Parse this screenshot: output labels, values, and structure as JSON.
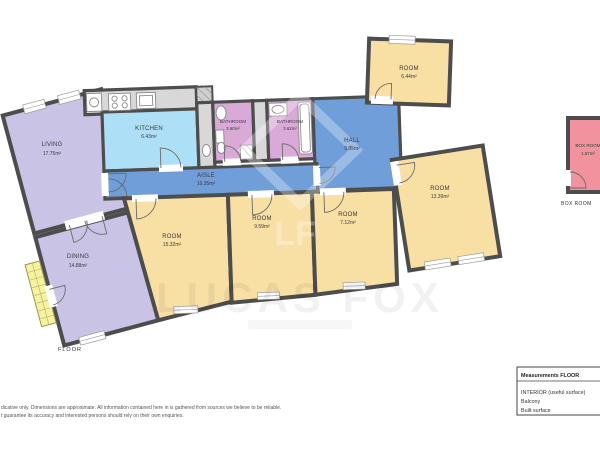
{
  "rooms": [
    {
      "name": "LIVING",
      "area": "17.75m²"
    },
    {
      "name": "DINING",
      "area": "14.88m²"
    },
    {
      "name": "KITCHEN",
      "area": "6.43m²"
    },
    {
      "name": "BATHROOM",
      "area": "3.60m²"
    },
    {
      "name": "BATHROOM",
      "area": "3.62m²"
    },
    {
      "name": "AISLE",
      "area": "10.35m²"
    },
    {
      "name": "HALL",
      "area": "9.85m²"
    },
    {
      "name": "ROOM",
      "area": "6.44m²"
    },
    {
      "name": "ROOM",
      "area": "15.32m²"
    },
    {
      "name": "ROOM",
      "area": "9.59m²"
    },
    {
      "name": "ROOM",
      "area": "7.12m²"
    },
    {
      "name": "ROOM",
      "area": "13.39m²"
    },
    {
      "name": "BOX ROOM",
      "area": "1.87m²"
    }
  ],
  "captions": {
    "floor": "FLOOR",
    "box_room": "BOX ROOM"
  },
  "legend": {
    "title": "Measurements FLOOR",
    "items": [
      "INTERIOR (useful surface)",
      "Balcony",
      "Built surface"
    ]
  },
  "disclaimer": [
    "dicative only. Dimensions are approximate. All information contained here in is gathered from sources we believe to be reliable.",
    "t guarantee its accuracy and interested persons should rely on their own enquiries."
  ],
  "watermark": {
    "text": "LUCAS FOX",
    "logo": "LF"
  },
  "colors": {
    "unit": "#c9c3e6",
    "kitchen": "#ade0f6",
    "bathroom": "#d9a9d8",
    "circulation": "#6f9ed9",
    "room": "#f8e0a4",
    "box_room": "#f1929e",
    "balcony": "#f6f39f",
    "wall": "#4d4d4d",
    "counter": "#d8d8d8"
  }
}
